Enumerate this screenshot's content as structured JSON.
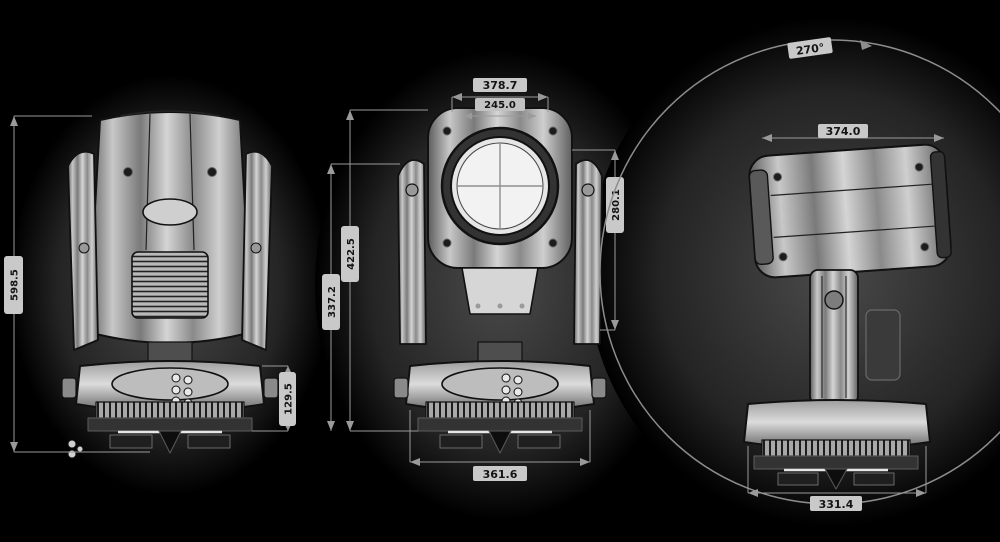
{
  "front_view": {
    "overall_height": "598.5",
    "base_height": "129.5"
  },
  "beam_view": {
    "head_width": "378.7",
    "lens_width": "245.0",
    "overall_height": "422.5",
    "arm_height": "337.2",
    "head_height": "280.1",
    "base_width": "361.6"
  },
  "side_view": {
    "tilt_range": "270°",
    "head_depth": "374.0",
    "base_depth": "331.4"
  },
  "colors": {
    "background": "#000000",
    "line": "#111111",
    "metal_light": "#d9d9d9",
    "metal_dark": "#6e6e6e",
    "label_strip": "#c9c9c9",
    "label_text": "#141414"
  }
}
